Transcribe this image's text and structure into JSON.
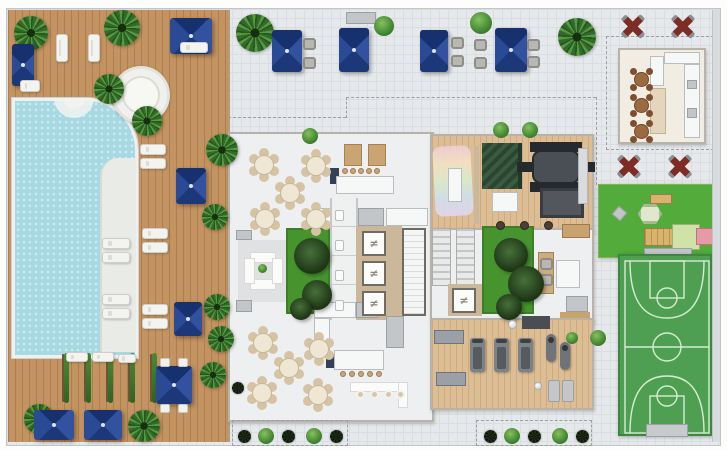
{
  "glyphs": {
    "elevator": "≠"
  },
  "colors": {
    "deck": "#c39361",
    "pool": "#a7d9e2",
    "tile": "#e6e9eb",
    "tileline": "#dadde1",
    "wood": "#dcbd94",
    "garden": "#47942f",
    "lawn": "#52ab3a",
    "court": "#4f9f52",
    "courtline": "#d6ecd2",
    "red": "#7d2d25",
    "white": "#edeff0",
    "wall": "#b7b3ab",
    "cream": "#f2ede2",
    "chair": "#d6c3a4"
  },
  "furniture": {
    "palms": [
      [
        14,
        16,
        34
      ],
      [
        104,
        10,
        36
      ],
      [
        94,
        74,
        30
      ],
      [
        132,
        106,
        30
      ],
      [
        206,
        134,
        32
      ],
      [
        202,
        204,
        26
      ],
      [
        204,
        294,
        26
      ],
      [
        208,
        326,
        26
      ],
      [
        24,
        404,
        30
      ],
      [
        128,
        410,
        32
      ],
      [
        200,
        362,
        26
      ],
      [
        236,
        14,
        38
      ],
      [
        558,
        18,
        38
      ]
    ],
    "bushes": [
      [
        470,
        12,
        22
      ],
      [
        374,
        16,
        20
      ],
      [
        493,
        122,
        16
      ],
      [
        522,
        122,
        16
      ],
      [
        302,
        128,
        16
      ],
      [
        590,
        330,
        16
      ],
      [
        566,
        332,
        12
      ],
      [
        258,
        428,
        16
      ],
      [
        306,
        428,
        16
      ],
      [
        504,
        428,
        16
      ],
      [
        552,
        428,
        16
      ]
    ],
    "dark_plants": [
      [
        238,
        430,
        13
      ],
      [
        282,
        430,
        13
      ],
      [
        330,
        430,
        13
      ],
      [
        484,
        430,
        13
      ],
      [
        528,
        430,
        13
      ],
      [
        576,
        430,
        13
      ],
      [
        232,
        382,
        12
      ]
    ],
    "garden_plants": [
      [
        294,
        238,
        36
      ],
      [
        302,
        280,
        30
      ],
      [
        290,
        298,
        22
      ],
      [
        494,
        238,
        34
      ],
      [
        508,
        266,
        36
      ],
      [
        496,
        294,
        26
      ]
    ],
    "vines": [
      [
        64,
        353
      ],
      [
        86,
        353
      ],
      [
        108,
        353
      ],
      [
        130,
        353
      ],
      [
        152,
        353
      ]
    ],
    "umbrellas_blue": [
      [
        12,
        44,
        22,
        42
      ],
      [
        170,
        18,
        42,
        36
      ],
      [
        176,
        168,
        30,
        36
      ],
      [
        174,
        302,
        28,
        34
      ],
      [
        156,
        366,
        36,
        38
      ],
      [
        34,
        410,
        40,
        30
      ],
      [
        84,
        410,
        38,
        30
      ],
      [
        272,
        30,
        30,
        42
      ],
      [
        339,
        28,
        30,
        44
      ],
      [
        420,
        30,
        28,
        42
      ],
      [
        495,
        28,
        32,
        44
      ]
    ],
    "umbrellas_red": [
      [
        618,
        12,
        30
      ],
      [
        668,
        12,
        30
      ],
      [
        614,
        152,
        30
      ],
      [
        665,
        152,
        30
      ]
    ],
    "loungers": [
      [
        56,
        34,
        12,
        28
      ],
      [
        88,
        34,
        12,
        28
      ],
      [
        20,
        80,
        20,
        12
      ],
      [
        180,
        42,
        28,
        11
      ],
      [
        140,
        144,
        26,
        11
      ],
      [
        140,
        158,
        26,
        11
      ],
      [
        142,
        228,
        26,
        11
      ],
      [
        142,
        242,
        26,
        11
      ],
      [
        142,
        304,
        26,
        11
      ],
      [
        142,
        318,
        26,
        11
      ],
      [
        102,
        238,
        28,
        11
      ],
      [
        102,
        252,
        28,
        11
      ],
      [
        102,
        294,
        28,
        11
      ],
      [
        102,
        308,
        28,
        11
      ],
      [
        66,
        352,
        22,
        10
      ],
      [
        92,
        352,
        22,
        10
      ],
      [
        118,
        354,
        18,
        9
      ]
    ],
    "deck_chairs": [
      [
        160,
        358,
        10,
        9
      ],
      [
        178,
        358,
        10,
        9
      ],
      [
        160,
        404,
        10,
        9
      ],
      [
        178,
        404,
        10,
        9
      ]
    ],
    "armchairs": [
      [
        303,
        38
      ],
      [
        303,
        57
      ],
      [
        451,
        37
      ],
      [
        451,
        55
      ],
      [
        474,
        39
      ],
      [
        474,
        57
      ],
      [
        527,
        39
      ],
      [
        527,
        56
      ]
    ],
    "dining_tables": [
      [
        254,
        155
      ],
      [
        306,
        156
      ],
      [
        280,
        183
      ],
      [
        255,
        209
      ],
      [
        306,
        209
      ],
      [
        253,
        333
      ],
      [
        309,
        339
      ],
      [
        279,
        358
      ],
      [
        252,
        383
      ],
      [
        308,
        385
      ]
    ],
    "gourmet_tables": [
      [
        634,
        72
      ],
      [
        634,
        98
      ],
      [
        634,
        124
      ]
    ],
    "stools": [
      [
        342,
        168
      ],
      [
        350,
        168
      ],
      [
        358,
        168
      ],
      [
        366,
        168
      ],
      [
        374,
        168
      ],
      [
        340,
        371
      ],
      [
        349,
        371
      ],
      [
        358,
        371
      ],
      [
        367,
        371
      ],
      [
        376,
        371
      ]
    ],
    "elevators": [
      [
        362,
        231
      ],
      [
        362,
        261
      ],
      [
        362,
        291
      ],
      [
        452,
        288
      ]
    ],
    "bath_fixtures": [
      [
        335,
        210
      ],
      [
        335,
        240
      ],
      [
        335,
        270
      ],
      [
        335,
        300
      ]
    ],
    "treadmills": [
      [
        470,
        338
      ],
      [
        494,
        338
      ],
      [
        518,
        338
      ]
    ],
    "bikes": [
      [
        546,
        334
      ],
      [
        560,
        342
      ]
    ],
    "poufs": [
      [
        496,
        221
      ],
      [
        520,
        221
      ],
      [
        544,
        221
      ]
    ],
    "swivel_chairs": [
      [
        356,
        390
      ],
      [
        370,
        390
      ],
      [
        384,
        390
      ],
      [
        396,
        390
      ]
    ],
    "gym_mats": [
      [
        548,
        380
      ],
      [
        562,
        380
      ]
    ],
    "balls": [
      [
        508,
        320,
        9
      ],
      [
        534,
        382,
        8
      ]
    ]
  },
  "areas": {
    "pool_deck": "wood deck with pool and loungers",
    "terrace": "tiled terrace with umbrellas",
    "clubhouse": "dining rooms, bars, gardens, elevator core",
    "games_room": "kids and meeting room",
    "gym": "fitness room",
    "gourmet_room": "party room with parasols",
    "playground": "lawn with play structure",
    "sports_court": "basketball court"
  }
}
